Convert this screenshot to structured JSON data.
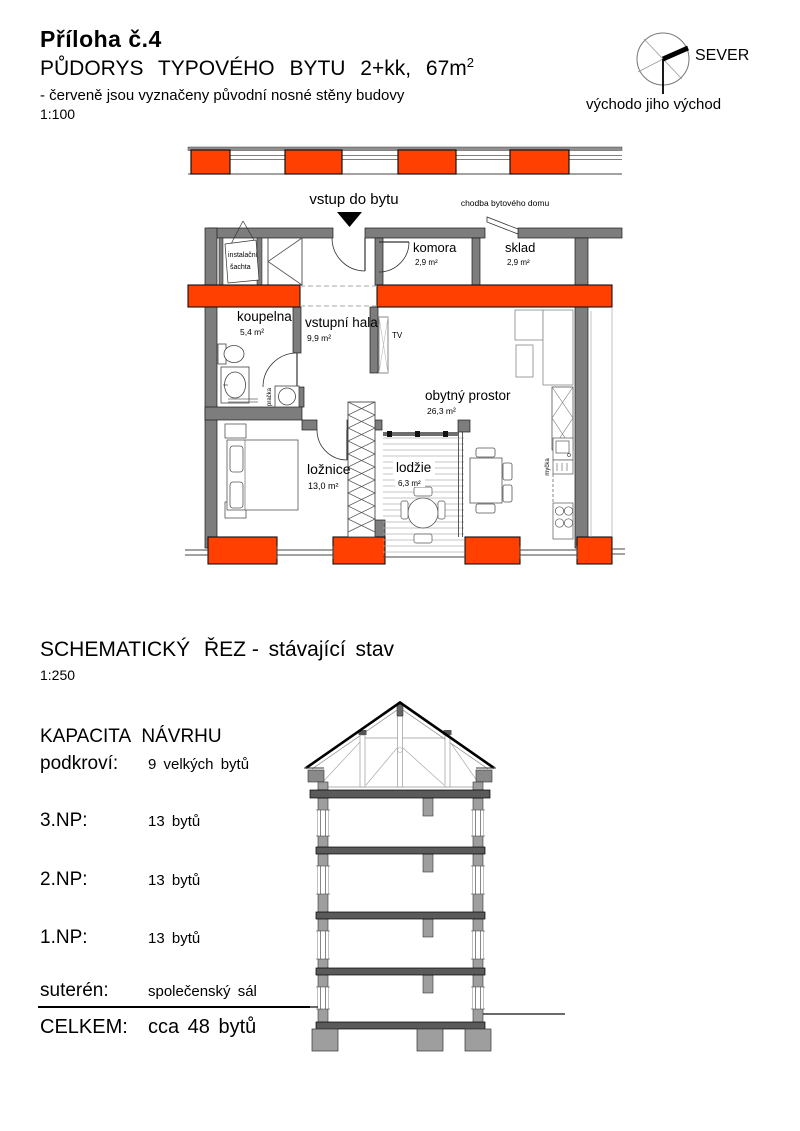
{
  "header": {
    "attachment": "Příloha č.4",
    "title": "PŮDORYS TYPOVÉHO BYTU 2+kk, 67m",
    "title_sup": "2",
    "note": "- červeně jsou vyznačeny původní nosné stěny budovy",
    "scale": "1:100"
  },
  "compass": {
    "north": "SEVER",
    "direction": "východo jiho východ"
  },
  "plan": {
    "entry": "vstup do bytu",
    "corridor": "chodba bytového domu",
    "shaft_line1": "instalační",
    "shaft_line2": "šachta",
    "komora": "komora",
    "komora_area": "2,9 m²",
    "sklad": "sklad",
    "sklad_area": "2,9 m²",
    "koupelna": "koupelna",
    "koupelna_area": "5,4 m²",
    "hala": "vstupní hala",
    "hala_area": "9,9 m²",
    "obytny": "obytný prostor",
    "obytny_area": "26,3 m²",
    "loznice": "ložnice",
    "loznice_area": "13,0 m²",
    "lodzie": "lodžie",
    "lodzie_area": "6,3 m²",
    "tv": "TV",
    "pracka": "pračka",
    "mycka": "myčka"
  },
  "section": {
    "title": "SCHEMATICKÝ ŘEZ",
    "subtitle": "- stávající stav",
    "scale": "1:250"
  },
  "capacity": {
    "heading": "KAPACITA NÁVRHU",
    "rows": [
      {
        "label": "podkroví:",
        "value": "9 velkých bytů"
      },
      {
        "label": "3.NP:",
        "value": "13 bytů"
      },
      {
        "label": "2.NP:",
        "value": "13 bytů"
      },
      {
        "label": "1.NP:",
        "value": "13 bytů"
      },
      {
        "label": "suterén:",
        "value": "společenský sál"
      }
    ],
    "total_label": "CELKEM:",
    "total_value": "cca 48 bytů"
  },
  "colors": {
    "load_bearing_red": "#FF4000",
    "wall_gray": "#7d7d7d"
  }
}
